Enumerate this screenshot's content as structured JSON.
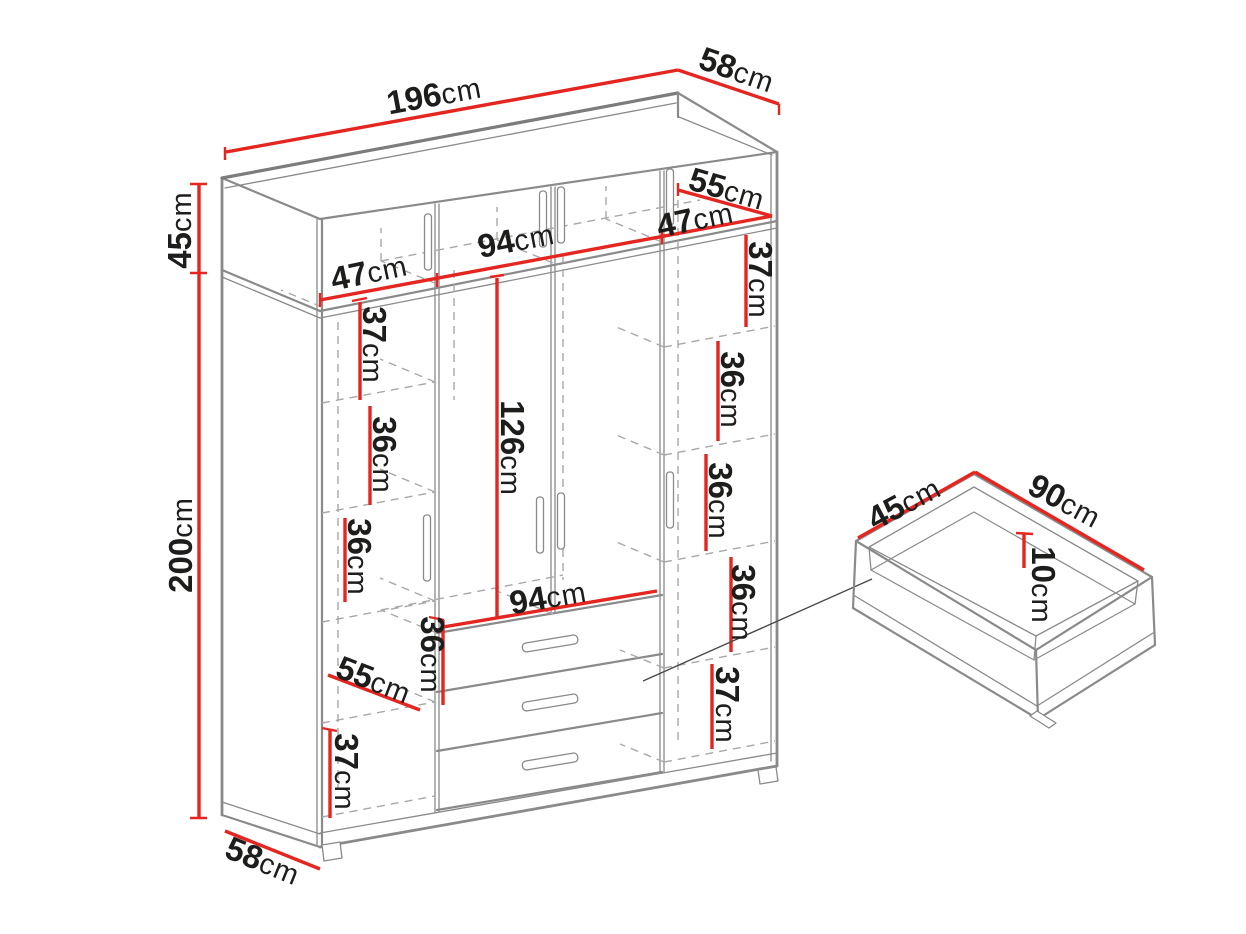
{
  "colors": {
    "dimension": "#e52620",
    "outline": "#8a8a8a",
    "dashed": "#a8a8a8",
    "text": "#1d1d1b",
    "bg": "#ffffff"
  },
  "wardrobe": {
    "overall": {
      "width": {
        "value": "196",
        "unit": "cm"
      },
      "top_depth": {
        "value": "58",
        "unit": "cm"
      },
      "top_section_height": {
        "value": "45",
        "unit": "cm"
      },
      "height": {
        "value": "200",
        "unit": "cm"
      },
      "bottom_depth": {
        "value": "58",
        "unit": "cm"
      }
    },
    "top_cabinet": {
      "left_compartment_width": {
        "value": "47",
        "unit": "cm"
      },
      "middle_compartment_width": {
        "value": "94",
        "unit": "cm"
      },
      "right_compartment_width": {
        "value": "47",
        "unit": "cm"
      },
      "shelf_depth": {
        "value": "55",
        "unit": "cm"
      }
    },
    "left_column": {
      "shelf_spacings": [
        {
          "value": "37",
          "unit": "cm"
        },
        {
          "value": "36",
          "unit": "cm"
        },
        {
          "value": "36",
          "unit": "cm"
        },
        {
          "value": "36",
          "unit": "cm"
        },
        {
          "value": "37",
          "unit": "cm"
        }
      ],
      "shelf_depth": {
        "value": "55",
        "unit": "cm"
      }
    },
    "middle_section": {
      "door_height": {
        "value": "126",
        "unit": "cm"
      },
      "inner_width": {
        "value": "94",
        "unit": "cm"
      }
    },
    "right_column": {
      "shelf_spacings": [
        {
          "value": "37",
          "unit": "cm"
        },
        {
          "value": "36",
          "unit": "cm"
        },
        {
          "value": "36",
          "unit": "cm"
        },
        {
          "value": "36",
          "unit": "cm"
        },
        {
          "value": "37",
          "unit": "cm"
        }
      ]
    }
  },
  "drawer_detail": {
    "depth": {
      "value": "45",
      "unit": "cm"
    },
    "width": {
      "value": "90",
      "unit": "cm"
    },
    "inner_height": {
      "value": "10",
      "unit": "cm"
    }
  }
}
